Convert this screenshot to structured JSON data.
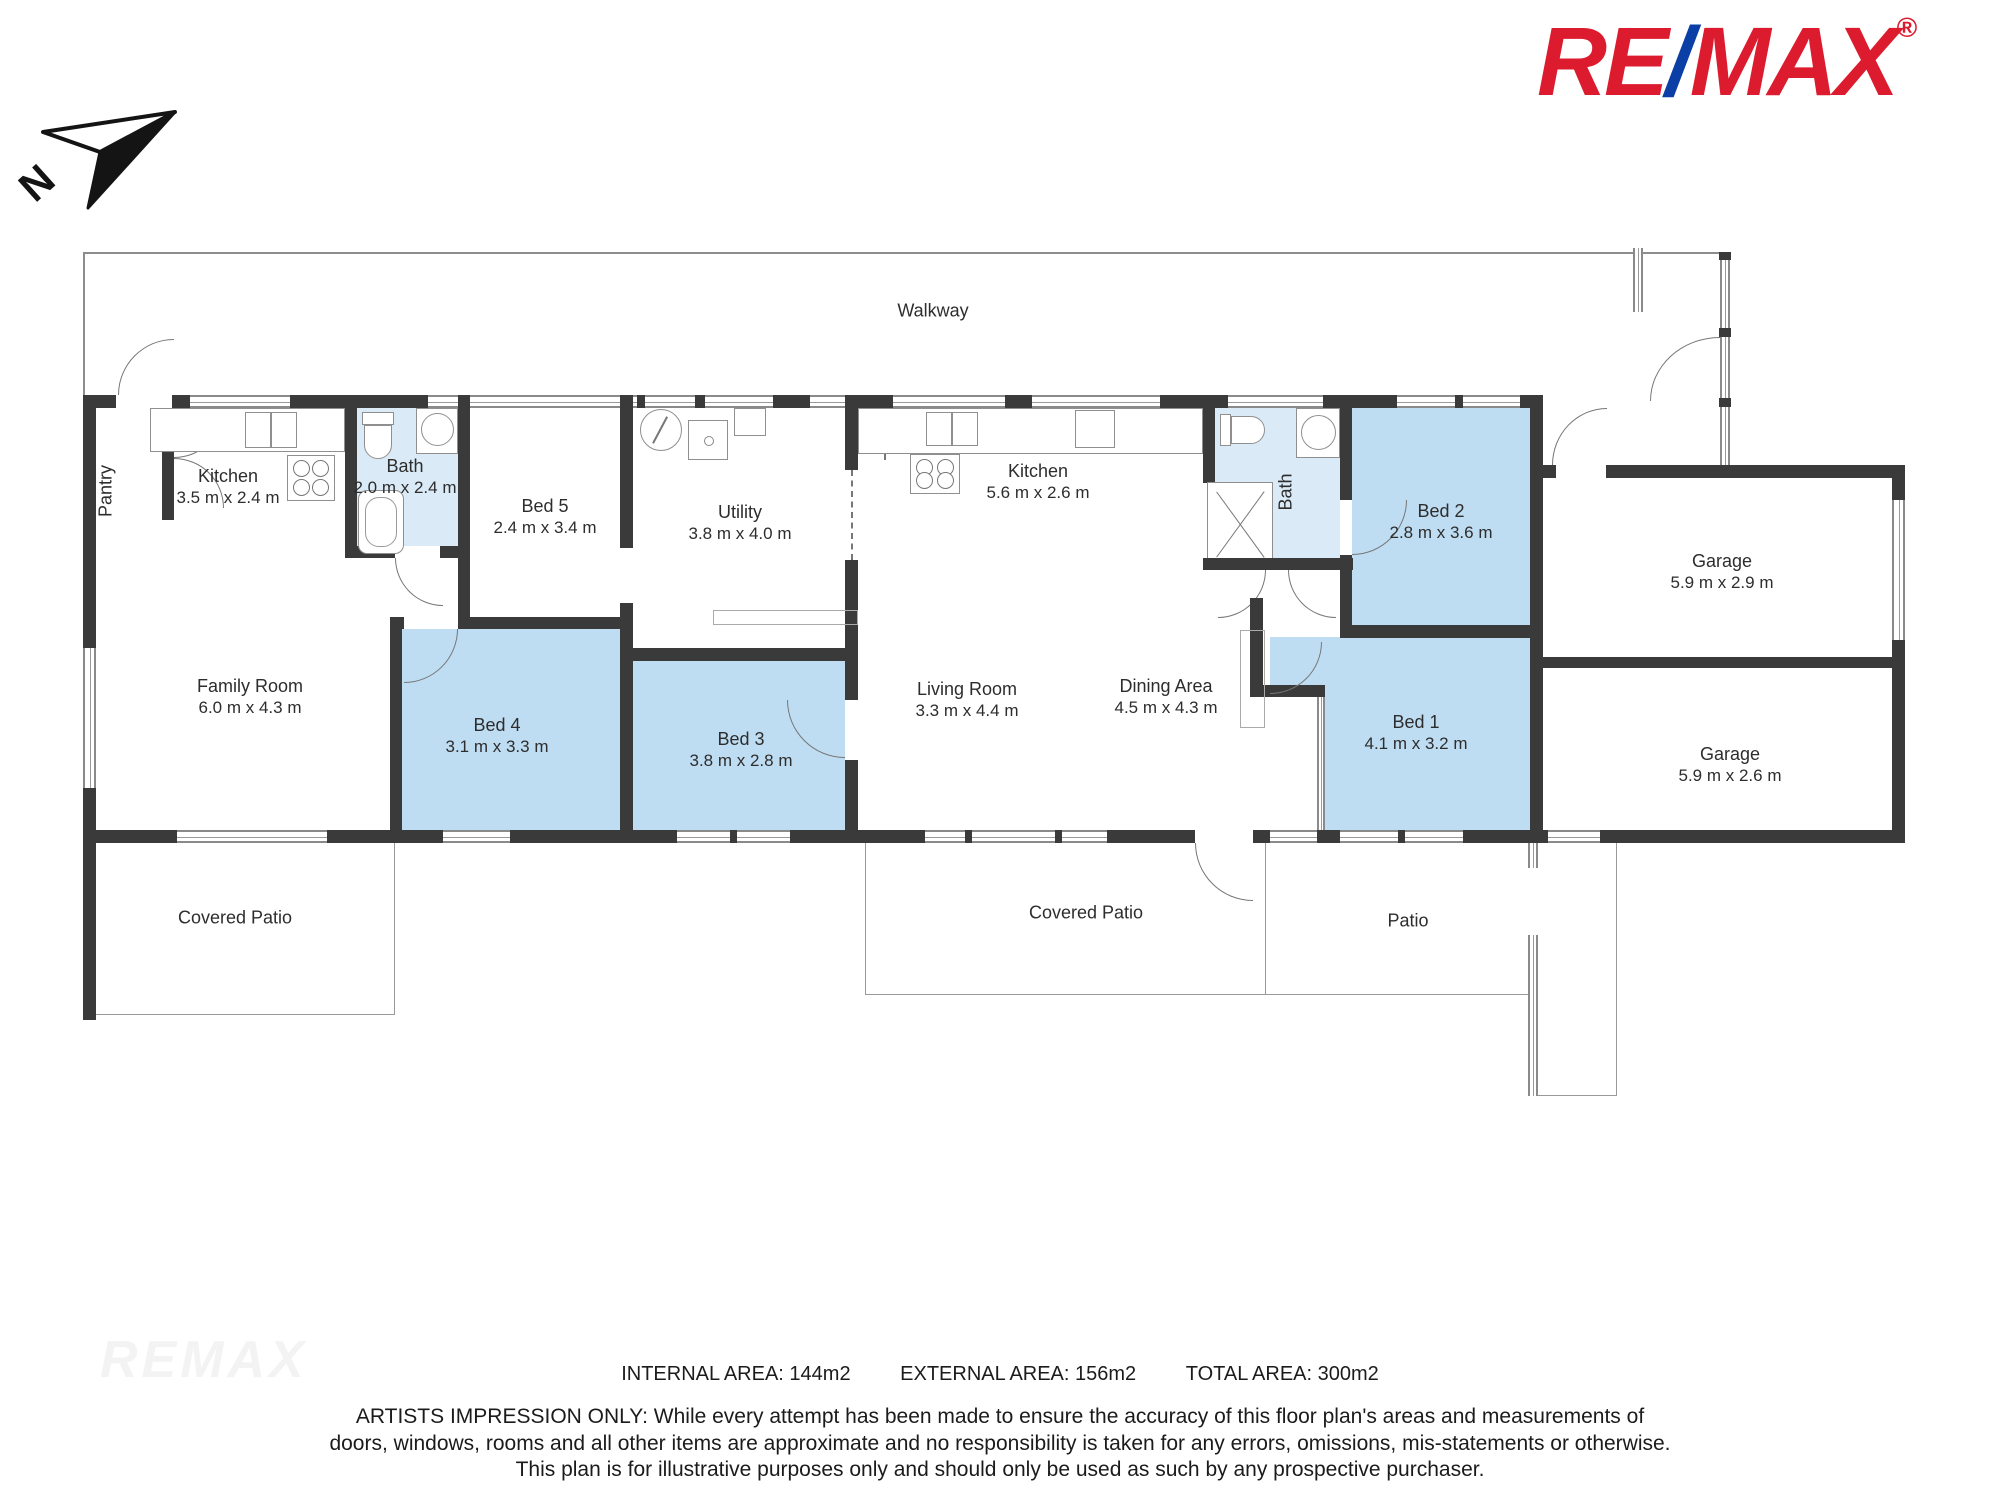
{
  "logo": {
    "re": "RE",
    "slash": "/",
    "max": "MAX",
    "reg": "®",
    "red": "#DC1C2E",
    "blue": "#0B3FA5"
  },
  "north_label": "N",
  "watermark": "REMAX",
  "areas": {
    "internal": "INTERNAL AREA: 144m2",
    "external": "EXTERNAL AREA: 156m2",
    "total": "TOTAL AREA: 300m2"
  },
  "disclaimer": {
    "line1": "ARTISTS IMPRESSION ONLY: While every attempt has been made to ensure the accuracy of this floor plan's areas and measurements of",
    "line2": "doors, windows, rooms and all other items are approximate and no responsibility is taken for any errors, omissions, mis-statements or otherwise.",
    "line3": "This plan is for illustrative purposes only and should only be used as such by any prospective purchaser."
  },
  "plan": {
    "colors": {
      "wall": "#3a3a3a",
      "bedroom_fill": "#bfddf2",
      "bath_fill": "#daeaf6",
      "line": "#999999"
    },
    "rooms": [
      {
        "name": "Walkway",
        "x": 933,
        "y": 311
      },
      {
        "name": "Pantry",
        "x": 106,
        "y": 491,
        "vertical": true
      },
      {
        "name": "Kitchen",
        "dims": "3.5 m x 2.4 m",
        "x": 228,
        "y": 477
      },
      {
        "name": "Bath",
        "dims": "2.0 m x 2.4 m",
        "x": 405,
        "y": 467
      },
      {
        "name": "Bed 5",
        "dims": "2.4 m x 3.4 m",
        "x": 545,
        "y": 507
      },
      {
        "name": "Utility",
        "dims": "3.8 m x 4.0 m",
        "x": 740,
        "y": 513
      },
      {
        "name": "Kitchen",
        "dims": "5.6 m x 2.6 m",
        "x": 1038,
        "y": 472
      },
      {
        "name": "Bath",
        "x": 1286,
        "y": 492,
        "vertical": true
      },
      {
        "name": "Bed 2",
        "dims": "2.8 m x 3.6 m",
        "x": 1441,
        "y": 512
      },
      {
        "name": "Garage",
        "dims": "5.9 m x 2.9 m",
        "x": 1722,
        "y": 562
      },
      {
        "name": "Family Room",
        "dims": "6.0 m x 4.3 m",
        "x": 250,
        "y": 687
      },
      {
        "name": "Bed 4",
        "dims": "3.1 m x 3.3 m",
        "x": 497,
        "y": 726
      },
      {
        "name": "Bed 3",
        "dims": "3.8 m x 2.8 m",
        "x": 741,
        "y": 740
      },
      {
        "name": "Living Room",
        "dims": "3.3 m x 4.4 m",
        "x": 967,
        "y": 690
      },
      {
        "name": "Dining Area",
        "dims": "4.5 m x 4.3 m",
        "x": 1166,
        "y": 687
      },
      {
        "name": "Bed 1",
        "dims": "4.1 m x 3.2 m",
        "x": 1416,
        "y": 723
      },
      {
        "name": "Garage",
        "dims": "5.9 m x 2.6 m",
        "x": 1730,
        "y": 755
      },
      {
        "name": "Covered Patio",
        "x": 235,
        "y": 918
      },
      {
        "name": "Covered Patio",
        "x": 1086,
        "y": 913
      },
      {
        "name": "Patio",
        "x": 1408,
        "y": 921
      }
    ]
  }
}
